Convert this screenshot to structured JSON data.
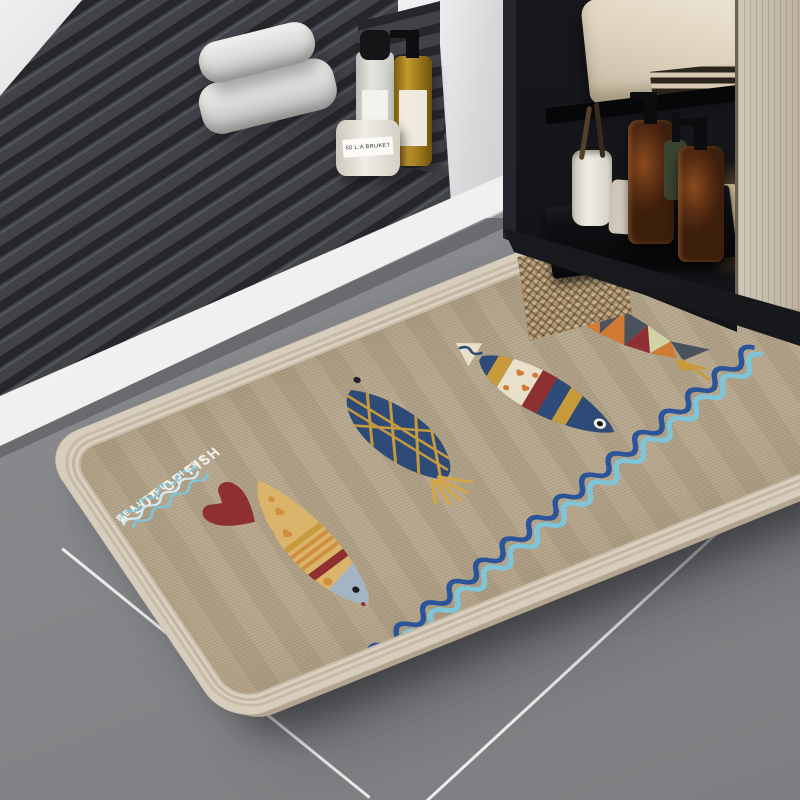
{
  "mat": {
    "title": "A LOT OF FISH",
    "subtitle": "BEAUTIFUL HOME",
    "motifs": [
      "triangle fish",
      "striped fish",
      "navy net fish",
      "yellow spotted fish",
      "red heart",
      "double wave border"
    ]
  },
  "products": {
    "jar_label": "50 L:A BRUKET"
  },
  "colors": {
    "floor_gray": "#87888b",
    "floor_gray_light": "#8f9093",
    "floor_gray_dark": "#7d7e81",
    "seam_white": "#eceded",
    "slat_gap": "#26272b",
    "slat_face": "#404248",
    "slat_hi": "#54565e",
    "mat_border": "#d7cdbd",
    "mat_fabric": "#b4a489",
    "navy": "#2e4b78",
    "gold": "#c79a3c",
    "dark_red": "#8e2f32",
    "orange": "#d07a33",
    "cream": "#e9e0ca",
    "sage": "#cfd3a6",
    "slate": "#4a525c",
    "fish_head_gray": "#a3b4c4",
    "wave_dark_blue": "#2b559b",
    "wave_light_blue": "#7fc5da",
    "text_white": "#f4f2ec",
    "wood": "#c9bfae",
    "cabinet_black": "#141518"
  }
}
